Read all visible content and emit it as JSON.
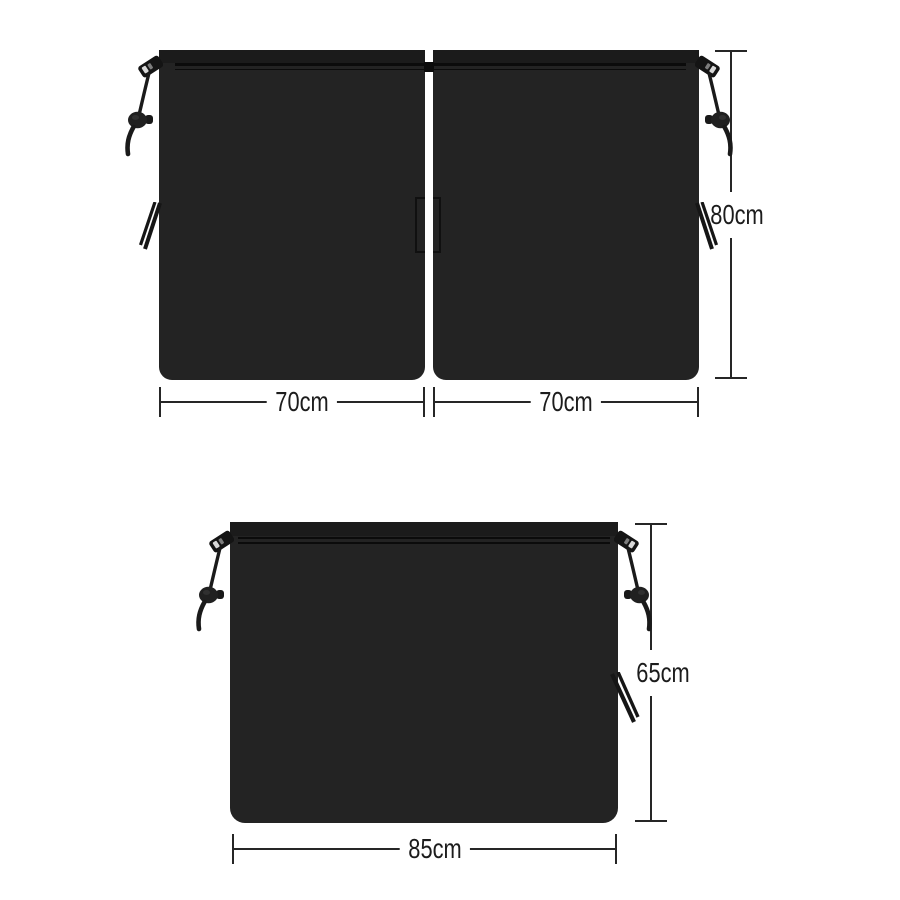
{
  "diagram": {
    "kind": "product-dimension-diagram",
    "background": "#ffffff"
  },
  "colors": {
    "panel_fill": "#232323",
    "panel_top_strip": "#1b1b1b",
    "seam_line": "#0b0b0b",
    "dimension_line": "#262626",
    "label_text": "#1c1c1c",
    "hardware": "#161616"
  },
  "top_view": {
    "left_panel": {
      "width_label": "70cm"
    },
    "right_panel": {
      "width_label": "70cm"
    },
    "height_label": "80cm"
  },
  "bottom_view": {
    "panel": {
      "width_label": "85cm",
      "height_label": "65cm"
    }
  }
}
